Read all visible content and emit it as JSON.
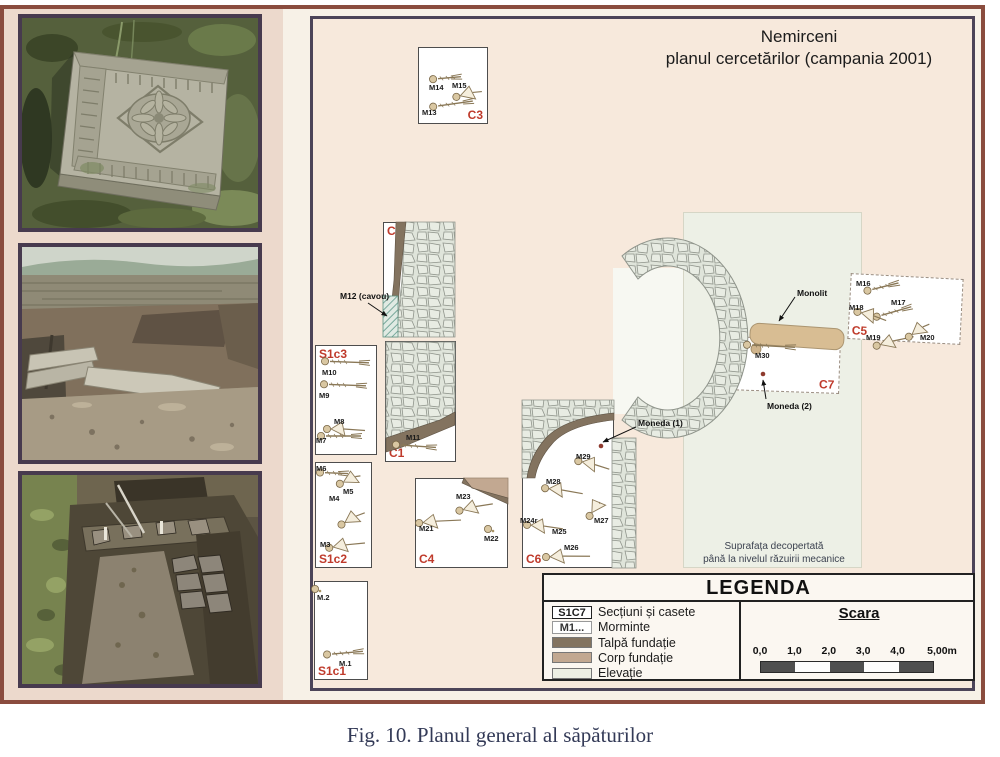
{
  "page": {
    "caption": "Fig. 10.  Planul general al săpăturilor"
  },
  "plan": {
    "title1": "Nemirceni",
    "title2": "planul cercetărilor (campania 2001)",
    "note1": "Suprafața decopertată",
    "note2": "până la nivelul răzuirii mecanice",
    "sections": [
      {
        "id": "C3",
        "label": "C3",
        "x": 418,
        "y": 47,
        "w": 70,
        "h": 77,
        "corner": "br",
        "dashed": false,
        "rot": 0
      },
      {
        "id": "C2",
        "label": "C2",
        "x": 383,
        "y": 222,
        "w": 72,
        "h": 115,
        "corner": "tl",
        "dashed": false,
        "rot": 0
      },
      {
        "id": "S1c3",
        "label": "S1c3",
        "x": 315,
        "y": 345,
        "w": 62,
        "h": 110,
        "corner": "tl",
        "dashed": false,
        "rot": 0
      },
      {
        "id": "C1",
        "label": "C1",
        "x": 385,
        "y": 341,
        "w": 71,
        "h": 121,
        "corner": "bl",
        "dashed": false,
        "rot": 0
      },
      {
        "id": "S1c2",
        "label": "S1c2",
        "x": 315,
        "y": 462,
        "w": 57,
        "h": 106,
        "corner": "bl",
        "dashed": false,
        "rot": 0
      },
      {
        "id": "C4",
        "label": "C4",
        "x": 415,
        "y": 478,
        "w": 93,
        "h": 90,
        "corner": "bl",
        "dashed": false,
        "rot": 0
      },
      {
        "id": "C6",
        "label": "C6",
        "x": 522,
        "y": 400,
        "w": 92,
        "h": 168,
        "corner": "bl",
        "dashed": false,
        "rot": 0
      },
      {
        "id": "S1c1",
        "label": "S1c1",
        "x": 314,
        "y": 581,
        "w": 54,
        "h": 99,
        "corner": "bl",
        "dashed": false,
        "rot": 0
      },
      {
        "id": "C7",
        "label": "C7",
        "x": 727,
        "y": 338,
        "w": 113,
        "h": 54,
        "corner": "br",
        "dashed": true,
        "rot": 2
      },
      {
        "id": "C5",
        "label": "C5",
        "x": 849,
        "y": 276,
        "w": 113,
        "h": 66,
        "corner": "bl",
        "dashed": true,
        "rot": 3
      }
    ],
    "graves": [
      {
        "label": "M13",
        "lx": 422,
        "ly": 109,
        "sx": 452,
        "sy": 104,
        "w": 46,
        "rot": -8,
        "type": "skeleton"
      },
      {
        "label": "M14",
        "lx": 429,
        "ly": 84,
        "sx": 446,
        "sy": 78,
        "w": 34,
        "rot": -5,
        "type": "skeleton"
      },
      {
        "label": "M15",
        "lx": 452,
        "ly": 82,
        "sx": 467,
        "sy": 94,
        "w": 30,
        "rot": -15,
        "type": "fan"
      },
      {
        "label": "M10",
        "lx": 322,
        "ly": 369,
        "sx": 346,
        "sy": 362,
        "w": 50,
        "rot": 2,
        "type": "skeleton"
      },
      {
        "label": "M9",
        "lx": 319,
        "ly": 392,
        "sx": 344,
        "sy": 385,
        "w": 48,
        "rot": 2,
        "type": "skeleton"
      },
      {
        "label": "M8",
        "lx": 334,
        "ly": 418,
        "sx": 344,
        "sy": 429,
        "w": 42,
        "rot": 0,
        "type": "fan"
      },
      {
        "label": "M7",
        "lx": 316,
        "ly": 437,
        "sx": 340,
        "sy": 436,
        "w": 46,
        "rot": 0,
        "type": "skeleton"
      },
      {
        "label": "M11",
        "lx": 406,
        "ly": 434,
        "sx": 415,
        "sy": 446,
        "w": 46,
        "rot": 4,
        "type": "skeleton"
      },
      {
        "label": "M6",
        "lx": 316,
        "ly": 465,
        "sx": 333,
        "sy": 473,
        "w": 34,
        "rot": 2,
        "type": "skeleton"
      },
      {
        "label": "M5",
        "lx": 343,
        "ly": 488,
        "sx": 348,
        "sy": 480,
        "w": 26,
        "rot": -25,
        "type": "fan"
      },
      {
        "label": "M4",
        "lx": 329,
        "ly": 495,
        "sx": 351,
        "sy": 519,
        "w": 30,
        "rot": -30,
        "type": "fan"
      },
      {
        "label": "M3",
        "lx": 320,
        "ly": 541,
        "sx": 345,
        "sy": 545,
        "w": 40,
        "rot": -10,
        "type": "fan"
      },
      {
        "label": "M23",
        "lx": 456,
        "ly": 493,
        "sx": 474,
        "sy": 507,
        "w": 38,
        "rot": -14,
        "type": "fan"
      },
      {
        "label": "M21",
        "lx": 419,
        "ly": 525,
        "sx": 438,
        "sy": 521,
        "w": 46,
        "rot": -6,
        "type": "fan"
      },
      {
        "label": "M22",
        "lx": 484,
        "ly": 535,
        "sx": 489,
        "sy": 529,
        "w": 10,
        "rot": 0,
        "type": "dot"
      },
      {
        "label": "M29",
        "lx": 576,
        "ly": 453,
        "sx": 592,
        "sy": 464,
        "w": 36,
        "rot": 12,
        "type": "fan"
      },
      {
        "label": "M28",
        "lx": 546,
        "ly": 478,
        "sx": 562,
        "sy": 490,
        "w": 42,
        "rot": 6,
        "type": "fan"
      },
      {
        "label": "M24r",
        "lx": 520,
        "ly": 517,
        "sx": 543,
        "sy": 526,
        "w": 40,
        "rot": 4,
        "type": "fan"
      },
      {
        "label": "M25",
        "lx": 552,
        "ly": 528,
        "sx": 0,
        "sy": 0,
        "w": 0,
        "rot": 0,
        "type": "none"
      },
      {
        "label": "M27",
        "lx": 594,
        "ly": 517,
        "sx": 593,
        "sy": 511,
        "w": 20,
        "rot": -55,
        "type": "fan"
      },
      {
        "label": "M26",
        "lx": 564,
        "ly": 544,
        "sx": 566,
        "sy": 556,
        "w": 48,
        "rot": -3,
        "type": "fan"
      },
      {
        "label": "M.2",
        "lx": 317,
        "ly": 594,
        "sx": 317,
        "sy": 589,
        "w": 12,
        "rot": 0,
        "type": "dot"
      },
      {
        "label": "M.1",
        "lx": 339,
        "ly": 660,
        "sx": 344,
        "sy": 653,
        "w": 42,
        "rot": -5,
        "type": "skeleton"
      },
      {
        "label": "M30",
        "lx": 755,
        "ly": 352,
        "sx": 770,
        "sy": 346,
        "w": 54,
        "rot": 3,
        "type": "skeleton"
      },
      {
        "label": "M16",
        "lx": 856,
        "ly": 280,
        "sx": 882,
        "sy": 287,
        "w": 38,
        "rot": -14,
        "type": "skeleton"
      },
      {
        "label": "M17",
        "lx": 891,
        "ly": 299,
        "sx": 893,
        "sy": 312,
        "w": 42,
        "rot": -16,
        "type": "skeleton"
      },
      {
        "label": "M18",
        "lx": 849,
        "ly": 304,
        "sx": 870,
        "sy": 315,
        "w": 34,
        "rot": 14,
        "type": "fan"
      },
      {
        "label": "M19",
        "lx": 866,
        "ly": 334,
        "sx": 893,
        "sy": 341,
        "w": 42,
        "rot": -16,
        "type": "fan"
      },
      {
        "label": "M20",
        "lx": 920,
        "ly": 334,
        "sx": 917,
        "sy": 331,
        "w": 28,
        "rot": -35,
        "type": "fan"
      }
    ],
    "annotations": [
      {
        "label": "M12 (cavou)",
        "lx": 340,
        "ly": 292,
        "x1": 368,
        "y1": 303,
        "x2": 387,
        "y2": 316
      },
      {
        "label": "Moneda (1)",
        "lx": 638,
        "ly": 419,
        "x1": 636,
        "y1": 427,
        "x2": 603,
        "y2": 442
      },
      {
        "label": "Monolit",
        "lx": 797,
        "ly": 289,
        "x1": 795,
        "y1": 297,
        "x2": 779,
        "y2": 321
      },
      {
        "label": "Moneda (2)",
        "lx": 767,
        "ly": 402,
        "x1": 766,
        "y1": 399,
        "x2": 763,
        "y2": 380
      }
    ],
    "coins": [
      {
        "x": 601,
        "y": 446
      },
      {
        "x": 763,
        "y": 374
      }
    ]
  },
  "legend": {
    "title": "LEGENDA",
    "items": [
      {
        "key": "S1C7",
        "key_style": "box-strong",
        "swatch": "",
        "label": "Secțiuni și casete"
      },
      {
        "key": "M1...",
        "key_style": "box-light",
        "swatch": "",
        "label": "Morminte"
      },
      {
        "key": "",
        "key_style": "swatch",
        "swatch": "#83735f",
        "label": "Talpă fundație"
      },
      {
        "key": "",
        "key_style": "swatch",
        "swatch": "#c2a891",
        "label": "Corp fundație"
      },
      {
        "key": "",
        "key_style": "swatch",
        "swatch": "#edefe3",
        "label": "Elevație"
      }
    ],
    "scale": {
      "title": "Scara",
      "ticks": [
        "0,0",
        "1,0",
        "2,0",
        "3,0",
        "4,0",
        "5,00m"
      ],
      "segments": 5
    }
  },
  "colors": {
    "accent_red": "#bf3a2b",
    "talpa": "#83735f",
    "corp": "#c2a891",
    "elevatie": "#edefe3",
    "monolit": "#d8bd93",
    "frame": "#8a4c3e",
    "plan_border": "#4c4458",
    "coin": "#8e3a2e"
  }
}
